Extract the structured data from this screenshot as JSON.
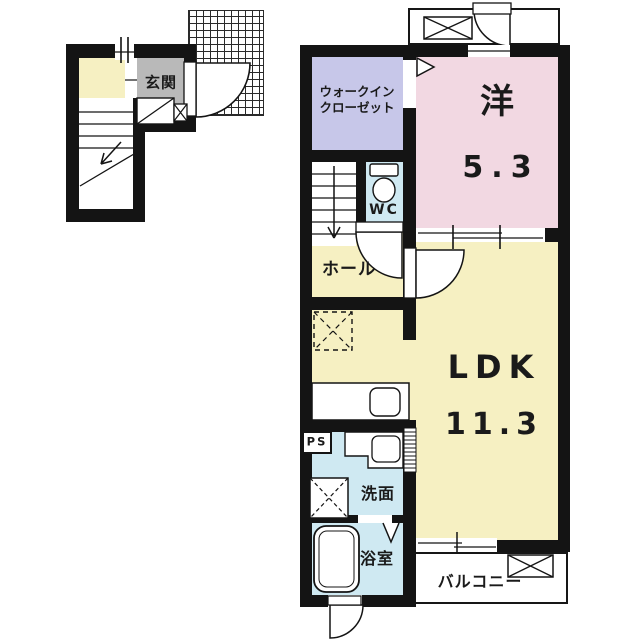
{
  "floor_plan": {
    "first_floor": {
      "entrance_label": "玄関"
    },
    "second_floor": {
      "walk_in_closet_line1": "ウォークイン",
      "walk_in_closet_line2": "クローゼット",
      "western_room_label": "洋",
      "western_room_size": "5.3",
      "wc_label": "WC",
      "hall_label": "ホール",
      "ldk_label": "LDK",
      "ldk_size": "11.3",
      "pipe_space_label": "PS",
      "washroom_label": "洗面",
      "bathroom_label": "浴室",
      "balcony_label": "バルコニー"
    },
    "colors": {
      "wall": "#141414",
      "room_yellow": "#f6f0c2",
      "room_pink": "#f2d8e2",
      "room_lavender": "#c7c7e9",
      "room_blue": "#cfe9f2",
      "entrance_gray": "#b9b9b9",
      "background": "#ffffff"
    }
  }
}
